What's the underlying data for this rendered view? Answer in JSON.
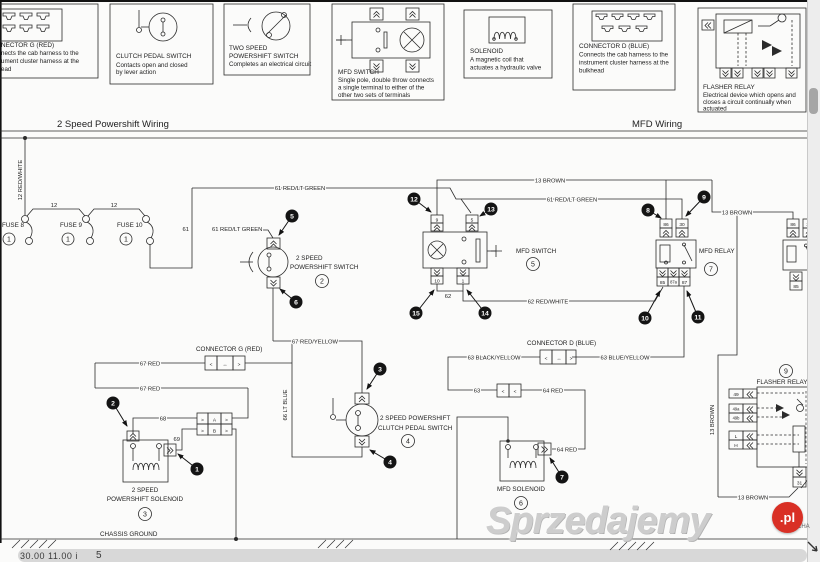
{
  "titles": {
    "left": "2 Speed Powershift Wiring",
    "right": "MFD Wiring"
  },
  "legend": [
    {
      "t1": "NECTOR G (RED)",
      "d1": "nects the cab harness to the",
      "d2": "ument cluster harness at the",
      "d3": "ead"
    },
    {
      "t1": "CLUTCH PEDAL SWITCH",
      "d1": "Contacts open and closed",
      "d2": "by lever action"
    },
    {
      "t1": "TWO SPEED",
      "t2": "POWERSHIFT SWITCH",
      "d1": "Completes an electrical circuit"
    },
    {
      "t1": "MFD SWITCH",
      "d1": "Single pole, double throw connects",
      "d2": "a single terminal to either of the",
      "d3": "other two sets of terminals"
    },
    {
      "t1": "SOLENOID",
      "d1": "A magnetic coil that",
      "d2": "actuates a hydraulic valve"
    },
    {
      "t1": "CONNECTOR D (BLUE)",
      "d1": "Connects the cab harness to the",
      "d2": "instrument cluster harness at the",
      "d3": "bulkhead"
    },
    {
      "t1": "FLASHER RELAY",
      "d1": "Electrical device which opens and",
      "d2": "closes a circuit continually when",
      "d3": "actuated"
    }
  ],
  "fuses": {
    "f8": "FUSE 8",
    "f9": "FUSE 9",
    "f10": "FUSE 10",
    "num": "1"
  },
  "components": {
    "powershift_switch": {
      "l1": "2 SPEED",
      "l2": "POWERSHIFT SWITCH",
      "num": "2"
    },
    "powershift_solenoid": {
      "l1": "2 SPEED",
      "l2": "POWERSHIFT SOLENOID",
      "num": "3"
    },
    "clutch_switch": {
      "l1": "2 SPEED POWERSHIFT",
      "l2": "CLUTCH PEDAL SWITCH",
      "num": "4"
    },
    "mfd_switch": {
      "l1": "MFD SWITCH",
      "num": "5"
    },
    "mfd_solenoid": {
      "l1": "MFD SOLENOID",
      "num": "6"
    },
    "mfd_relay": {
      "l1": "MFD RELAY",
      "num": "7"
    },
    "flasher_relay": {
      "l1": "FLASHER RELAY",
      "num": "9"
    },
    "connector_g": {
      "l1": "CONNECTOR G (RED)"
    },
    "connector_d": {
      "l1": "CONNECTOR D (BLUE)"
    },
    "chassis_ground": {
      "l1": "CHASSIS GROUND"
    }
  },
  "wires": {
    "rw12": "12 RED/WHITE",
    "j12a": "12",
    "j12b": "12",
    "v61": "61",
    "rlg61a": "61 RED/LT GREEN",
    "rlg61b": "61 RED/LT GREEN",
    "rlg61c": "61 RED/LT GREEN",
    "bn13a": "13 BROWN",
    "bn13b": "13 BROWN",
    "bn13c": "13 BROWN",
    "bn13d": "13 BROWN",
    "w62": "62",
    "rw62": "62 RED/WHITE",
    "by63": "63 BLACK/YELLOW",
    "bl63": "63 BLUE/YELLOW",
    "w63": "63",
    "rd64a": "64 RED",
    "rd64b": "64 RED",
    "lb66": "66 LT BLUE",
    "ry67": "67 RED/YELLOW",
    "rd67a": "67 RED",
    "rd67b": "67 RED",
    "w68": "68",
    "w69": "69"
  },
  "terminals": {
    "t9": "9",
    "t5": "5",
    "t10": "10",
    "t1": "1",
    "r86": "86",
    "r30": "30",
    "r85": "85",
    "r87a": "87a",
    "r87": "87",
    "rr86": "86",
    "rr30": "30",
    "rr85": "85",
    "cA": "A",
    "cB": "B",
    "f49": "49",
    "f49a": "49a",
    "f49b": "49b",
    "fL": "L",
    "fH": "H",
    "f31": "31"
  },
  "symbols": {
    "lt": "<",
    "gt": ">",
    "lr": "↔"
  },
  "callouts": {
    "c1": "1",
    "c2": "2",
    "c3": "3",
    "c4": "4",
    "c5": "5",
    "c6": "6",
    "c7": "7",
    "c8": "8",
    "c9": "9",
    "c10": "10",
    "c11": "11",
    "c12": "12",
    "c13": "13",
    "c14": "14",
    "c15": "15"
  },
  "footer": {
    "left": "30.00   11.00 i",
    "num": "5",
    "edge": "CHA"
  },
  "watermark": {
    "text": "Sprzedajemy",
    "tld": ".pl",
    "accent": "#d93025"
  },
  "colors": {
    "line": "#2b2b2b",
    "paper": "#fbfbfa"
  }
}
